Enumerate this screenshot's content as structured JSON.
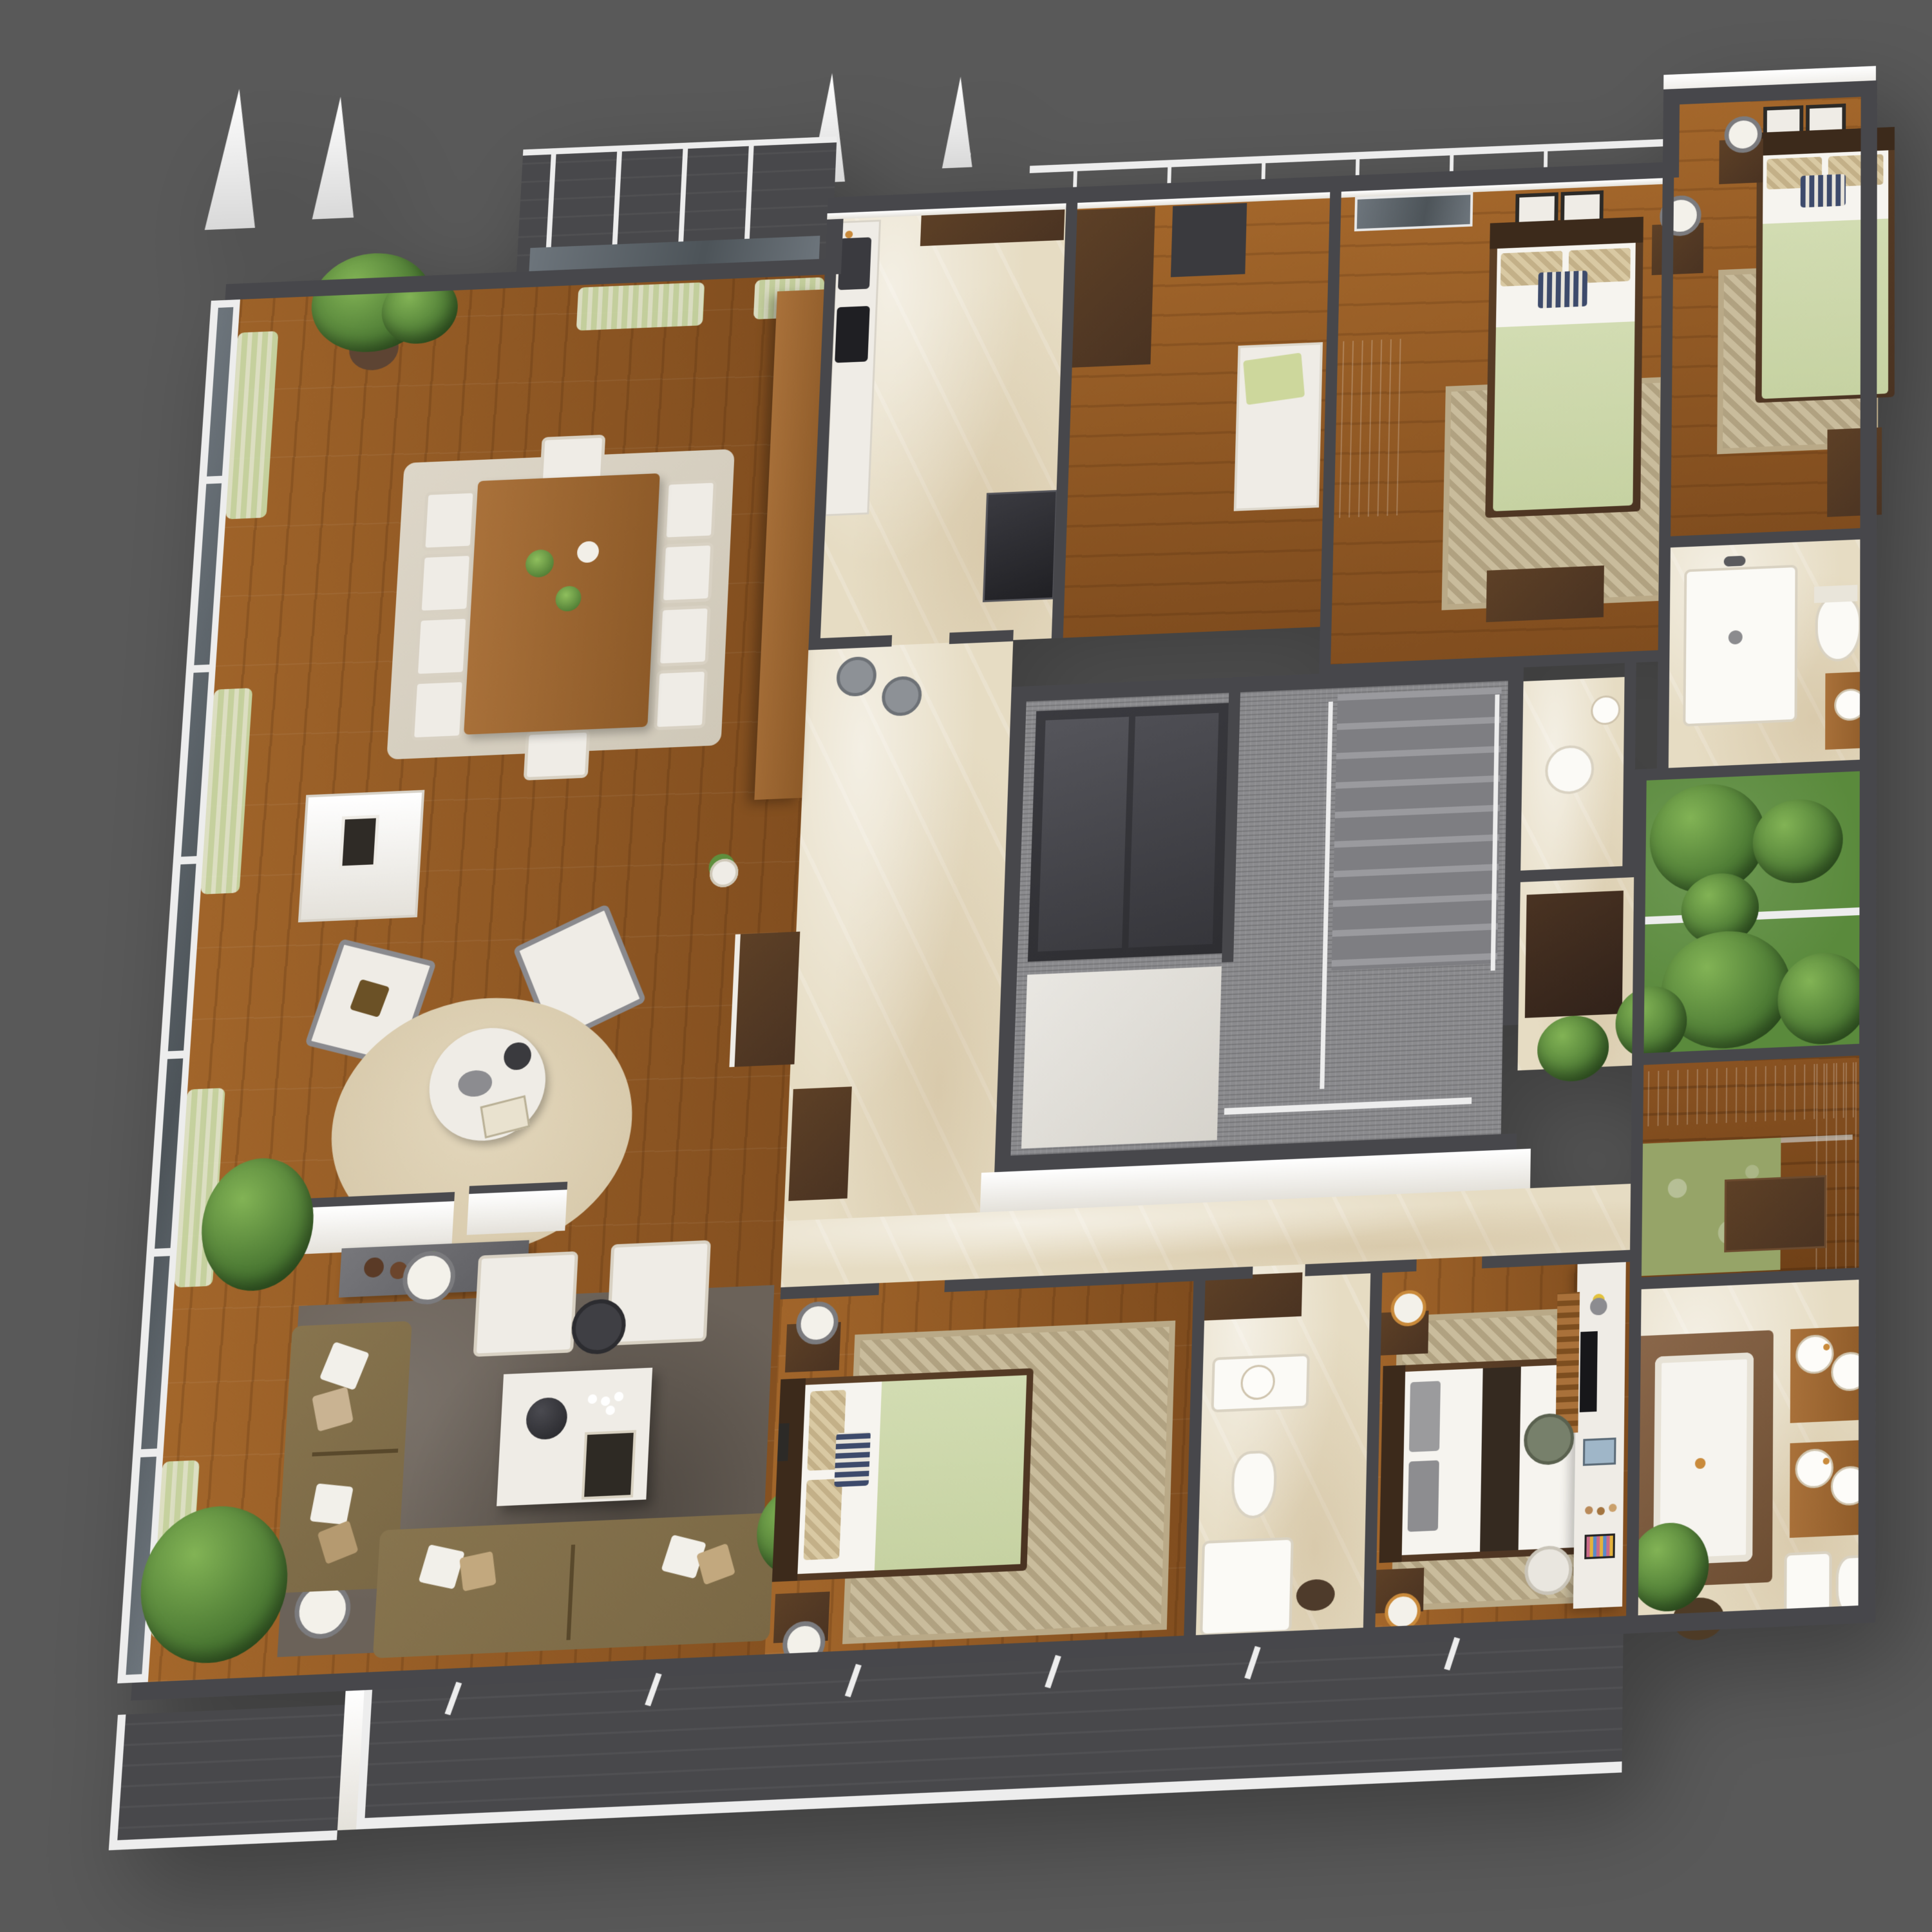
{
  "scene": {
    "type": "isometric-3d-floor-plan-render",
    "background": "#595959",
    "view": "top-down tilted axonometric, apartment cutaway with furnished rooms"
  },
  "palette": {
    "bg": "#595959",
    "wall": "#47474B",
    "white": "#F4F1EC",
    "wood": "#A4672B",
    "wood2": "#7F4C1E",
    "woodp": "#A9713A",
    "woodd": "#4A3322",
    "marble": "#E6DCC3",
    "deck": "#48484B",
    "rail": "#EDEDED",
    "glass": "#5E666C",
    "curtain": "#CBE0AE",
    "pdark": "#3E6B2B",
    "plight": "#82B355",
    "grass": "#5A8A3C",
    "sofa": "#7A6845",
    "rugd": "#6B6259",
    "rugc": "#D8CAAC",
    "rugt": "#C9BC9C",
    "rugg": "#96A468",
    "bedg": "#C6D2A2",
    "linen": "#F6F4EF",
    "furn": "#EFECE6",
    "gold": "#C98A3B",
    "carpet": "#8B8B8E",
    "elev": "#2E2E32",
    "runner": "#352A20",
    "lobby": "#DDDAD3"
  },
  "rooms": [
    {
      "name": "roof-terrace-top",
      "floor": "deck",
      "items": [
        "white-mullions",
        "railing"
      ]
    },
    {
      "name": "dining-area",
      "floor": "wood",
      "items": [
        "dining-table",
        "ten-white-chairs",
        "area-rug",
        "table-plants",
        "potted-palm",
        "green-sheer-curtains",
        "glass-curtain-wall"
      ]
    },
    {
      "name": "sitting-area",
      "floor": "wood",
      "items": [
        "fireplace-console",
        "two-wing-chairs",
        "round-cream-rug",
        "round-coffee-table",
        "partition-panels",
        "gray-console-with-vases",
        "potted-plant"
      ]
    },
    {
      "name": "living-room",
      "floor": "wood",
      "items": [
        "l-shaped-olive-sofa",
        "two-cream-armchairs",
        "dark-shag-rug",
        "white-coffee-table",
        "floor-lamps",
        "side-tables",
        "potted-palm"
      ]
    },
    {
      "name": "kitchen",
      "floor": "marble",
      "items": [
        "sink-counter",
        "mosaic-backsplash",
        "upper-cabinets",
        "range-oven",
        "tall-wood-partition"
      ]
    },
    {
      "name": "utility-hall",
      "floor": "wood",
      "items": [
        "tall-cabinet",
        "dark-shelf",
        "bench-with-green-cushion",
        "bar-stools"
      ]
    },
    {
      "name": "bedroom-3",
      "floor": "wood",
      "items": [
        "single-bed-green",
        "patterned-rug",
        "nightstand-lamp",
        "two-framed-prints",
        "wardrobe",
        "dresser",
        "sliding-glass-door"
      ]
    },
    {
      "name": "bedroom-4",
      "floor": "wood",
      "items": [
        "single-bed-green",
        "patterned-rug",
        "nightstand-lamp",
        "two-framed-prints",
        "dresser",
        "roof-ledge"
      ]
    },
    {
      "name": "bathroom-3",
      "floor": "marble",
      "items": [
        "shower-pan",
        "toilet",
        "wood-vanity-basin"
      ]
    },
    {
      "name": "stair-core",
      "floor": "carpet",
      "items": [
        "elevator-shaft",
        "elevator-lobby",
        "staircase",
        "white-railings"
      ]
    },
    {
      "name": "powder-room",
      "floor": "marble",
      "items": [
        "round-toilet",
        "cylinder-basin"
      ]
    },
    {
      "name": "hallway",
      "floor": "marble",
      "items": [
        "storage-cabinet",
        "potted-plant",
        "console"
      ]
    },
    {
      "name": "bedroom-2",
      "floor": "wood",
      "items": [
        "double-bed-green",
        "patterned-rug",
        "two-nightstands-lamps",
        "framed-prints"
      ]
    },
    {
      "name": "bathroom-2",
      "floor": "marble",
      "items": [
        "mirror-cabinet",
        "vanity",
        "toilet",
        "shower-pan"
      ]
    },
    {
      "name": "master-bedroom",
      "floor": "wood",
      "items": [
        "double-bed-white-brown-runner",
        "patterned-rug",
        "two-nightstands",
        "desk-with-laptop",
        "desk-chair",
        "vanity-counter-makeup",
        "tv-slat-panel",
        "stool"
      ]
    },
    {
      "name": "walk-in-closet",
      "floor": "wood",
      "items": [
        "wardrobe-runs-with-hangers",
        "island-dresser",
        "green-floral-rug",
        "glass-shelves"
      ]
    },
    {
      "name": "master-bathroom",
      "floor": "marble",
      "items": [
        "sunken-tub-wood-surround",
        "double-vanity-four-round-sinks-gold-faucets",
        "bidet",
        "toilet",
        "round-dark-rug",
        "palm-plant"
      ]
    },
    {
      "name": "balcony-garden",
      "floor": "grass",
      "items": [
        "dense-palms-and-shrubs",
        "white-railing",
        "divider-rail"
      ]
    },
    {
      "name": "terrace-main",
      "floor": "deck",
      "items": [
        "white-railing",
        "roof-beams"
      ]
    },
    {
      "name": "terrace-left",
      "floor": "deck",
      "items": [
        "white-railing"
      ]
    }
  ],
  "exterior": {
    "roof_sails": 4,
    "roof_rail_posts": 8,
    "glass_wall_side": "left",
    "curtain_color_name": "pale-green"
  }
}
